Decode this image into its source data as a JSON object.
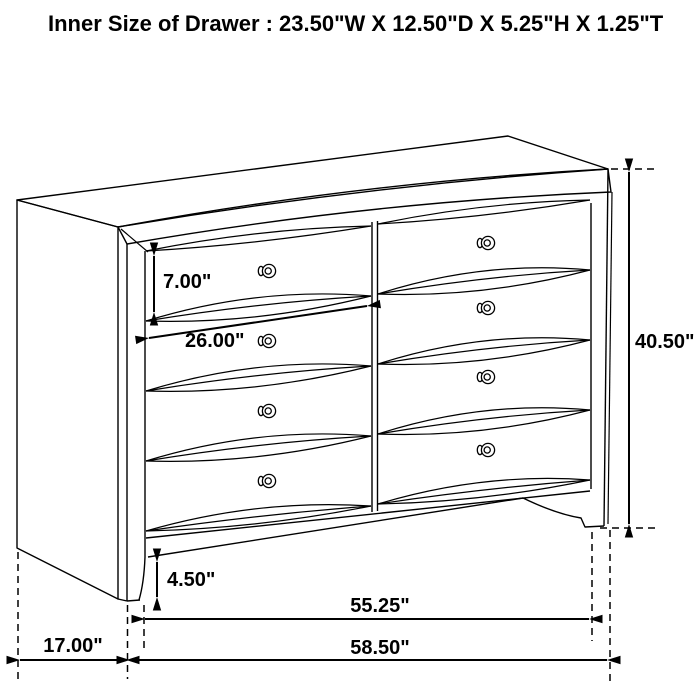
{
  "title": "Inner Size of Drawer : 23.50\"W X 12.50\"D X 5.25\"H X 1.25\"T",
  "diagram": {
    "subject": "dresser-line-drawing",
    "drawer_columns": 2,
    "drawer_rows": 4,
    "knob_count": 8,
    "colors": {
      "line": "#000000",
      "background": "#ffffff"
    },
    "dimensions": {
      "drawer_opening_height": {
        "label": "7.00\""
      },
      "drawer_opening_width": {
        "label": "26.00\""
      },
      "overall_height": {
        "label": "40.50\""
      },
      "base_height": {
        "label": "4.50\""
      },
      "foot_span_width": {
        "label": "55.25\""
      },
      "overall_width": {
        "label": "58.50\""
      },
      "depth": {
        "label": "17.00\""
      }
    }
  }
}
